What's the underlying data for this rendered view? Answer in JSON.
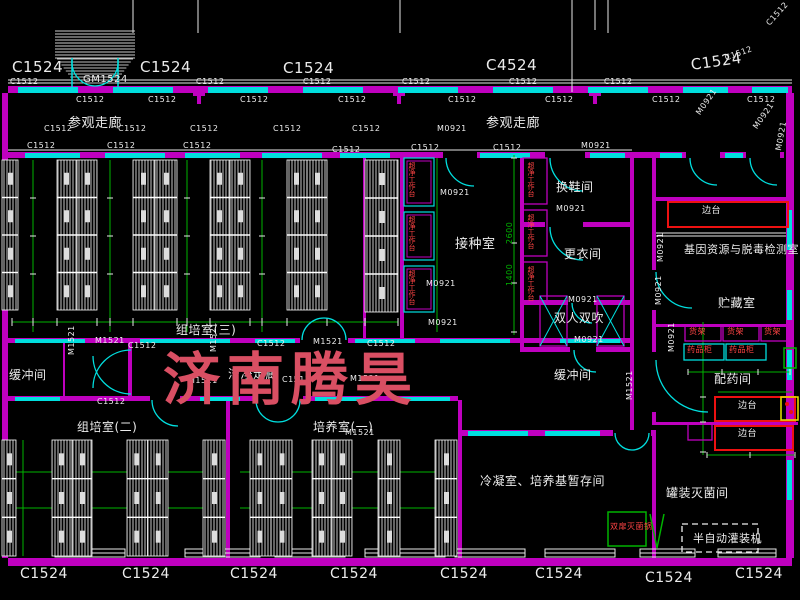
{
  "watermark": {
    "text": "济南腾昊",
    "color": "#d94f63"
  },
  "colors": {
    "background": "#000000",
    "wall": "#bf00bf",
    "window": "#00dede",
    "detail": "#e8e8e8",
    "grid": "#00b300",
    "equipment_red": "#ee1111",
    "equipment_yellow": "#e8e800",
    "label": "#ececec"
  },
  "labels": {
    "window_labels_top": [
      {
        "t": "C1524",
        "x": 12,
        "y": 60,
        "s": 15
      },
      {
        "t": "C1524",
        "x": 140,
        "y": 60,
        "s": 15
      },
      {
        "t": "C1524",
        "x": 283,
        "y": 61,
        "s": 15
      },
      {
        "t": "C4524",
        "x": 486,
        "y": 58,
        "s": 15
      },
      {
        "t": "C1524",
        "x": 690,
        "y": 58,
        "s": 15,
        "r": -8
      },
      {
        "t": "C1512",
        "x": 724,
        "y": 55,
        "s": 8,
        "r": -20
      },
      {
        "t": "C1512",
        "x": 765,
        "y": 22,
        "s": 8,
        "r": -48
      },
      {
        "t": "GM1524",
        "x": 83,
        "y": 75,
        "s": 10
      }
    ],
    "window_labels_bottom": [
      {
        "t": "C1524",
        "x": 20,
        "y": 567,
        "s": 14
      },
      {
        "t": "C1524",
        "x": 122,
        "y": 567,
        "s": 14
      },
      {
        "t": "C1524",
        "x": 230,
        "y": 567,
        "s": 14
      },
      {
        "t": "C1524",
        "x": 330,
        "y": 567,
        "s": 14
      },
      {
        "t": "C1524",
        "x": 440,
        "y": 567,
        "s": 14
      },
      {
        "t": "C1524",
        "x": 535,
        "y": 567,
        "s": 14
      },
      {
        "t": "C1524",
        "x": 645,
        "y": 571,
        "s": 14
      },
      {
        "t": "C1524",
        "x": 735,
        "y": 567,
        "s": 14
      }
    ],
    "wall_tags": [
      {
        "t": "C1512",
        "x": 10,
        "y": 78,
        "s": 8
      },
      {
        "t": "C1512",
        "x": 196,
        "y": 78,
        "s": 8
      },
      {
        "t": "C1512",
        "x": 303,
        "y": 78,
        "s": 8
      },
      {
        "t": "C1512",
        "x": 402,
        "y": 78,
        "s": 8
      },
      {
        "t": "C1512",
        "x": 509,
        "y": 78,
        "s": 8
      },
      {
        "t": "C1512",
        "x": 604,
        "y": 78,
        "s": 8
      },
      {
        "t": "C1512",
        "x": 76,
        "y": 96,
        "s": 8
      },
      {
        "t": "C1512",
        "x": 148,
        "y": 96,
        "s": 8
      },
      {
        "t": "C1512",
        "x": 240,
        "y": 96,
        "s": 8
      },
      {
        "t": "C1512",
        "x": 338,
        "y": 96,
        "s": 8
      },
      {
        "t": "C1512",
        "x": 448,
        "y": 96,
        "s": 8
      },
      {
        "t": "C1512",
        "x": 545,
        "y": 96,
        "s": 8
      },
      {
        "t": "C1512",
        "x": 652,
        "y": 96,
        "s": 8
      },
      {
        "t": "C1512",
        "x": 747,
        "y": 96,
        "s": 8
      },
      {
        "t": "C1512",
        "x": 44,
        "y": 125,
        "s": 8
      },
      {
        "t": "C1512",
        "x": 118,
        "y": 125,
        "s": 8
      },
      {
        "t": "C1512",
        "x": 190,
        "y": 125,
        "s": 8
      },
      {
        "t": "C1512",
        "x": 273,
        "y": 125,
        "s": 8
      },
      {
        "t": "C1512",
        "x": 352,
        "y": 125,
        "s": 8
      },
      {
        "t": "C1512",
        "x": 27,
        "y": 142,
        "s": 8
      },
      {
        "t": "C1512",
        "x": 107,
        "y": 142,
        "s": 8
      },
      {
        "t": "C1512",
        "x": 183,
        "y": 142,
        "s": 8
      },
      {
        "t": "C1512",
        "x": 332,
        "y": 146,
        "s": 8
      },
      {
        "t": "C1512",
        "x": 411,
        "y": 144,
        "s": 8
      },
      {
        "t": "C1512",
        "x": 493,
        "y": 144,
        "s": 8
      },
      {
        "t": "C1512",
        "x": 128,
        "y": 342,
        "s": 8
      },
      {
        "t": "C1512",
        "x": 257,
        "y": 340,
        "s": 8
      },
      {
        "t": "C1512",
        "x": 367,
        "y": 340,
        "s": 8
      },
      {
        "t": "C1512",
        "x": 282,
        "y": 376,
        "s": 8
      },
      {
        "t": "C1512",
        "x": 97,
        "y": 398,
        "s": 8
      }
    ],
    "door_tags": [
      {
        "t": "M0921",
        "x": 437,
        "y": 125,
        "s": 8
      },
      {
        "t": "M0921",
        "x": 581,
        "y": 142,
        "s": 8
      },
      {
        "t": "M0921",
        "x": 695,
        "y": 112,
        "s": 8,
        "r": -55
      },
      {
        "t": "M0921",
        "x": 752,
        "y": 126,
        "s": 8,
        "r": -55
      },
      {
        "t": "M0921",
        "x": 775,
        "y": 150,
        "s": 8,
        "r": -80
      },
      {
        "t": "M0921",
        "x": 440,
        "y": 189,
        "s": 8
      },
      {
        "t": "M0921",
        "x": 426,
        "y": 280,
        "s": 8
      },
      {
        "t": "M0921",
        "x": 428,
        "y": 319,
        "s": 8
      },
      {
        "t": "M0921",
        "x": 556,
        "y": 205,
        "s": 8
      },
      {
        "t": "M0921",
        "x": 568,
        "y": 296,
        "s": 8
      },
      {
        "t": "M0921",
        "x": 574,
        "y": 336,
        "s": 8
      },
      {
        "t": "M0921",
        "x": 657,
        "y": 262,
        "s": 8,
        "r": -90
      },
      {
        "t": "M0921",
        "x": 655,
        "y": 305,
        "s": 8,
        "r": -90
      },
      {
        "t": "M0921",
        "x": 668,
        "y": 352,
        "s": 8,
        "r": -90
      },
      {
        "t": "M1521",
        "x": 95,
        "y": 337,
        "s": 8
      },
      {
        "t": "M1521",
        "x": 313,
        "y": 338,
        "s": 8
      },
      {
        "t": "M1521",
        "x": 345,
        "y": 429,
        "s": 8
      },
      {
        "t": "M1521",
        "x": 188,
        "y": 377,
        "s": 8
      },
      {
        "t": "M1521",
        "x": 350,
        "y": 375,
        "s": 8
      },
      {
        "t": "M1521",
        "x": 68,
        "y": 355,
        "s": 8,
        "r": -90
      },
      {
        "t": "M1521",
        "x": 210,
        "y": 352,
        "s": 8,
        "r": -90
      },
      {
        "t": "M1521",
        "x": 626,
        "y": 400,
        "s": 8,
        "r": -90
      }
    ],
    "room_labels": [
      {
        "t": "参观走廊",
        "x": 68,
        "y": 117,
        "s": 13
      },
      {
        "t": "参观走廊",
        "x": 486,
        "y": 117,
        "s": 13
      },
      {
        "t": "换鞋间",
        "x": 556,
        "y": 181,
        "s": 12
      },
      {
        "t": "更衣间",
        "x": 564,
        "y": 248,
        "s": 12
      },
      {
        "t": "接种室",
        "x": 455,
        "y": 238,
        "s": 13
      },
      {
        "t": "双人双吹",
        "x": 554,
        "y": 312,
        "s": 12
      },
      {
        "t": "缓冲间",
        "x": 554,
        "y": 369,
        "s": 12
      },
      {
        "t": "缓冲间",
        "x": 9,
        "y": 369,
        "s": 12
      },
      {
        "t": "组培室(三)",
        "x": 176,
        "y": 324,
        "s": 12
      },
      {
        "t": "洁净走廊",
        "x": 228,
        "y": 368,
        "s": 12
      },
      {
        "t": "组培室(二)",
        "x": 77,
        "y": 421,
        "s": 12
      },
      {
        "t": "培养室(一)",
        "x": 313,
        "y": 421,
        "s": 12
      },
      {
        "t": "冷凝室、培养基暂存间",
        "x": 480,
        "y": 475,
        "s": 12
      },
      {
        "t": "罐装灭菌间",
        "x": 666,
        "y": 487,
        "s": 12
      },
      {
        "t": "基因资源与脱毒检测室",
        "x": 684,
        "y": 244,
        "s": 11
      },
      {
        "t": "贮藏室",
        "x": 718,
        "y": 297,
        "s": 12
      },
      {
        "t": "配药间",
        "x": 714,
        "y": 373,
        "s": 12
      }
    ],
    "equipment_labels": [
      {
        "t": "边台",
        "x": 702,
        "y": 207,
        "s": 9,
        "c": "#f0f0f0"
      },
      {
        "t": "边台",
        "x": 738,
        "y": 402,
        "s": 9,
        "c": "#f0f0f0"
      },
      {
        "t": "边台",
        "x": 738,
        "y": 430,
        "s": 9,
        "c": "#f0f0f0"
      },
      {
        "t": "货架",
        "x": 689,
        "y": 328,
        "s": 8,
        "c": "#ff4444"
      },
      {
        "t": "货架",
        "x": 727,
        "y": 328,
        "s": 8,
        "c": "#ff4444"
      },
      {
        "t": "货架",
        "x": 764,
        "y": 328,
        "s": 8,
        "c": "#ff4444"
      },
      {
        "t": "药品柜",
        "x": 687,
        "y": 346,
        "s": 8,
        "c": "#ff4444"
      },
      {
        "t": "药品柜",
        "x": 729,
        "y": 346,
        "s": 8,
        "c": "#ff4444"
      },
      {
        "t": "双扉灭菌锅",
        "x": 610,
        "y": 523,
        "s": 8,
        "c": "#ff4444"
      },
      {
        "t": "半自动灌装机",
        "x": 693,
        "y": 533,
        "s": 11,
        "c": "#f0f0f0"
      },
      {
        "t": "超净工作台",
        "x": 408,
        "y": 162,
        "s": 7,
        "c": "#ff4444",
        "v": true
      },
      {
        "t": "超净工作台",
        "x": 408,
        "y": 216,
        "s": 7,
        "c": "#ff4444",
        "v": true
      },
      {
        "t": "超净工作台",
        "x": 408,
        "y": 270,
        "s": 7,
        "c": "#ff4444",
        "v": true
      },
      {
        "t": "超净工作台",
        "x": 527,
        "y": 162,
        "s": 7,
        "c": "#ff4444",
        "v": true
      },
      {
        "t": "超净工作台",
        "x": 527,
        "y": 214,
        "s": 7,
        "c": "#ff4444",
        "v": true
      },
      {
        "t": "超净工作台",
        "x": 527,
        "y": 266,
        "s": 7,
        "c": "#ff4444",
        "v": true
      }
    ],
    "dimension_labels": [
      {
        "t": "2600",
        "x": 506,
        "y": 244,
        "s": 8,
        "c": "#00b300",
        "r": -90
      },
      {
        "t": "1400",
        "x": 506,
        "y": 286,
        "s": 8,
        "c": "#00b300",
        "r": -90
      }
    ]
  }
}
